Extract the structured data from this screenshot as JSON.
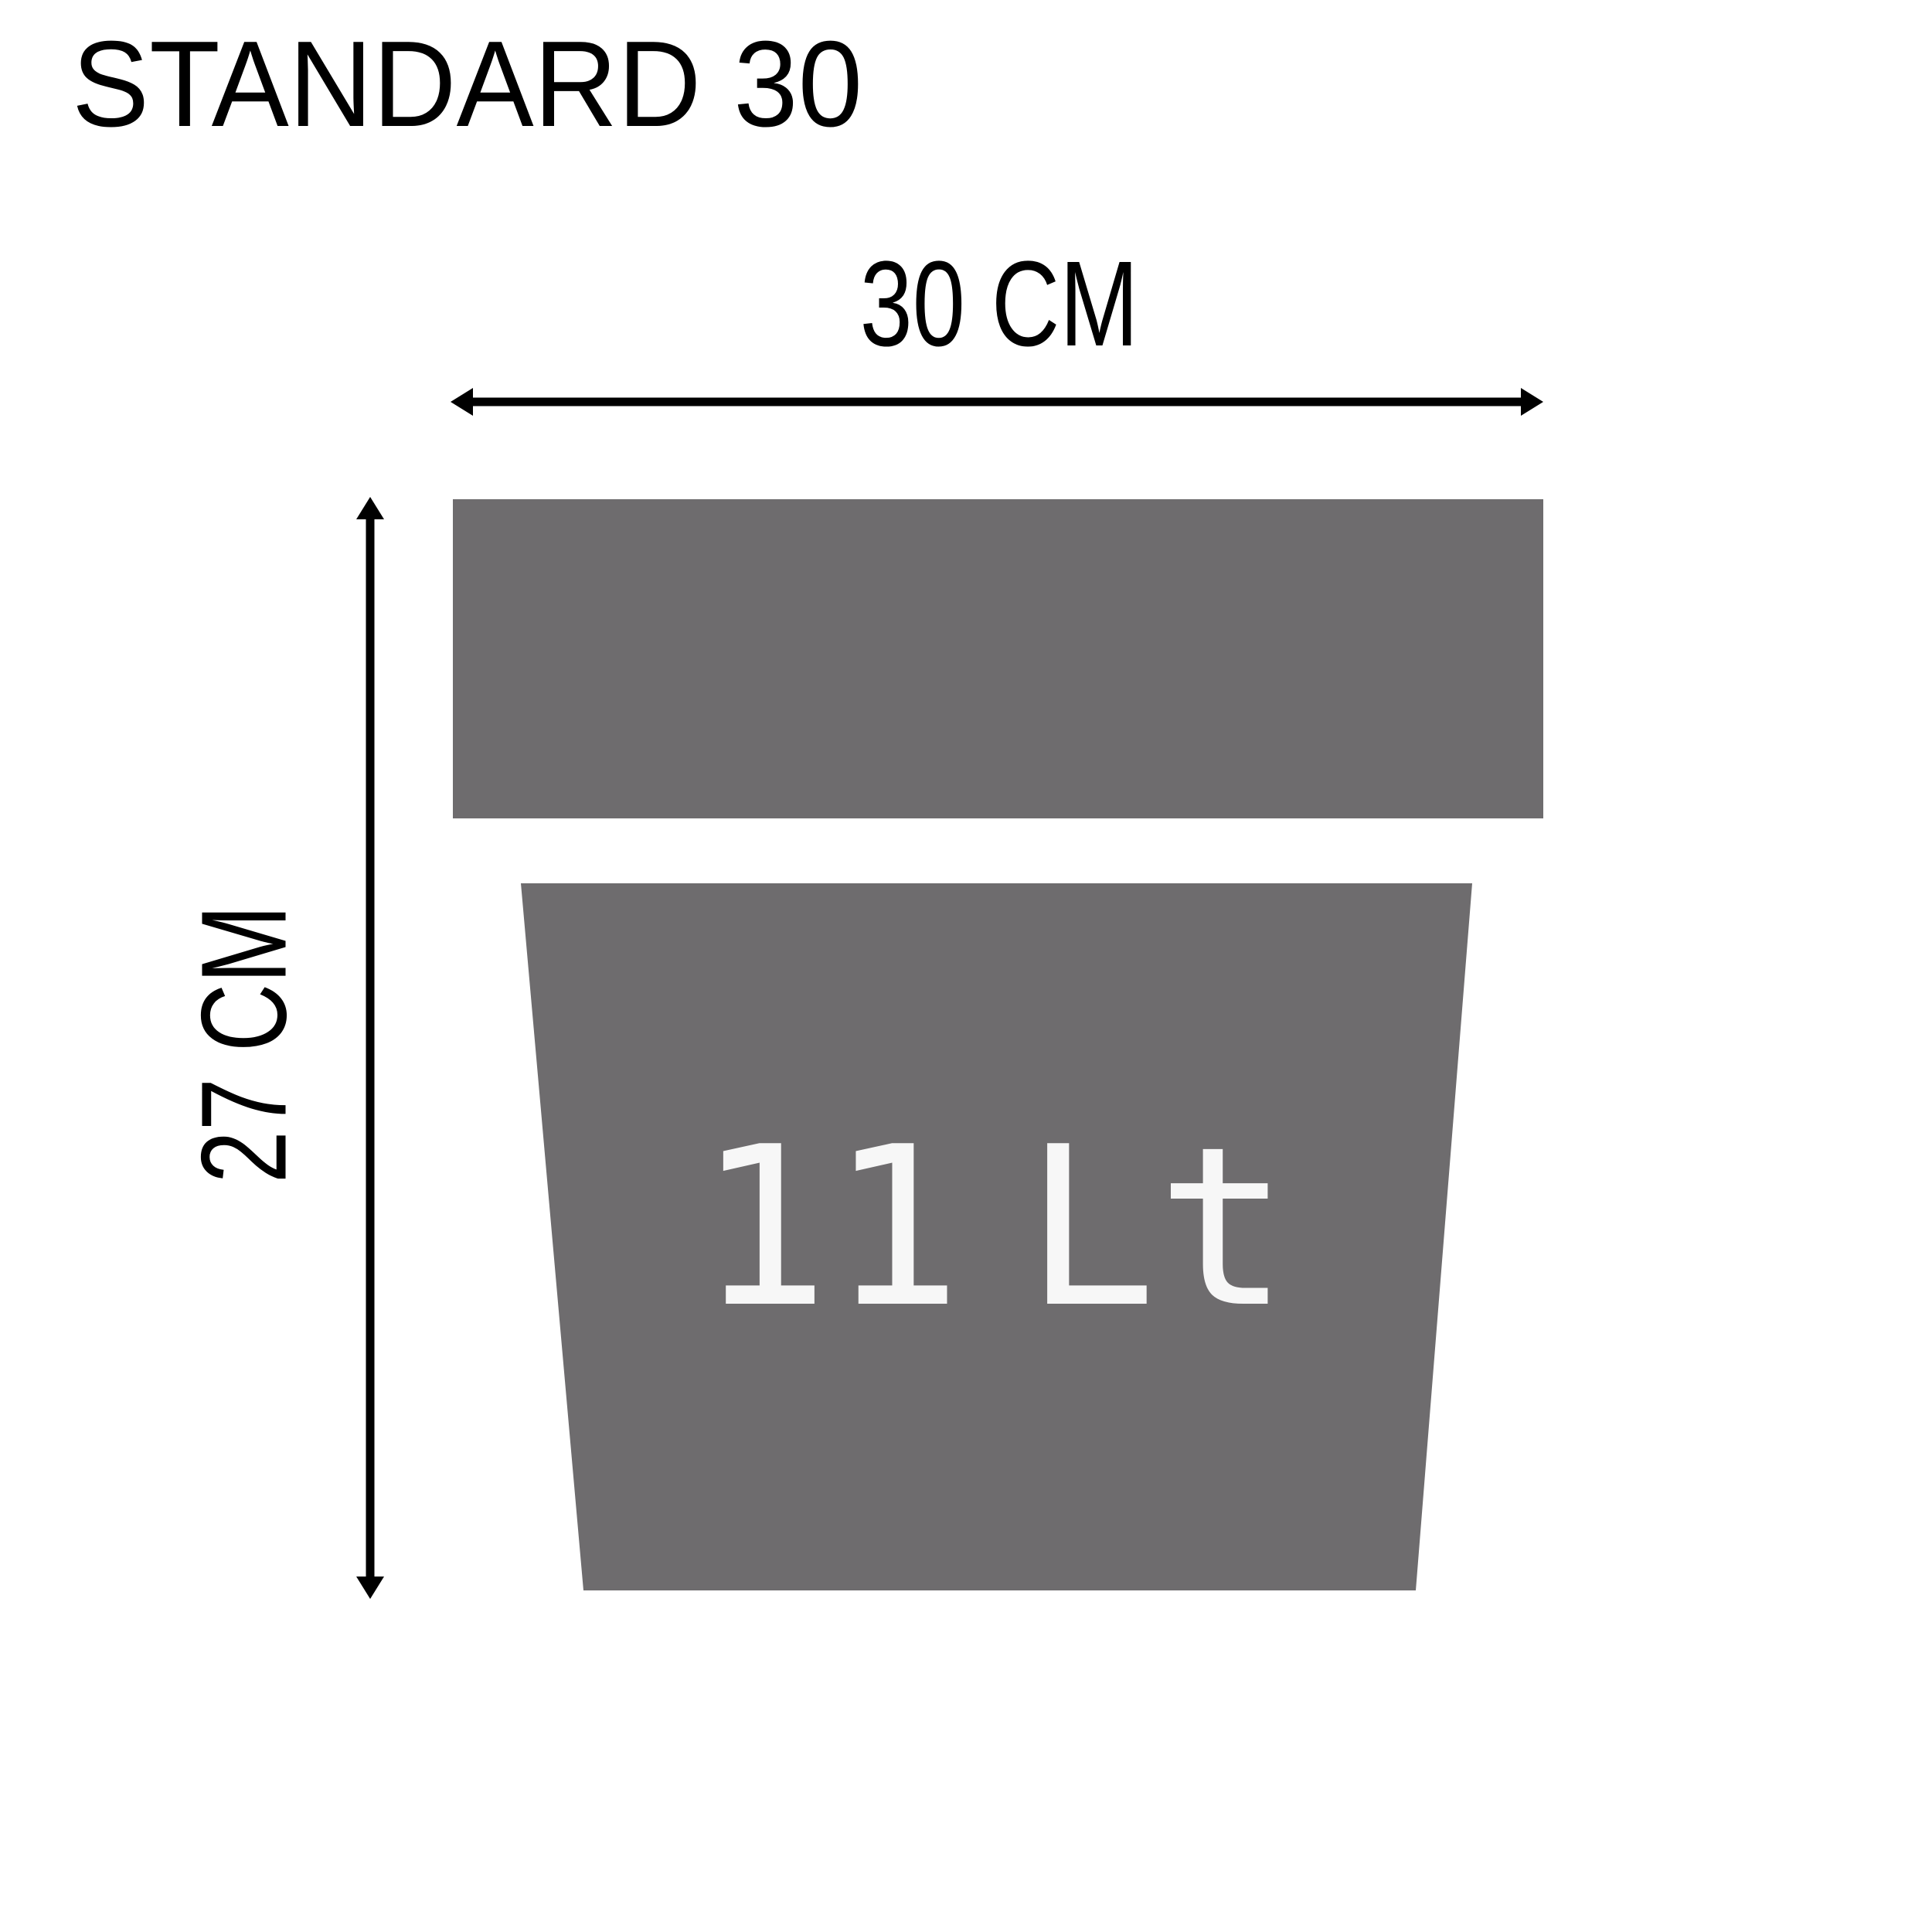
{
  "title": "STANDARD 30",
  "diagram": {
    "width_label": "30 CM",
    "height_label": "27 CM",
    "capacity_label": "11 Lt"
  },
  "colors": {
    "pot_gray": "#6E6C6E",
    "ink_black": "#000000",
    "capacity_white": "#F7F7F7",
    "background": "#FFFFFF"
  }
}
